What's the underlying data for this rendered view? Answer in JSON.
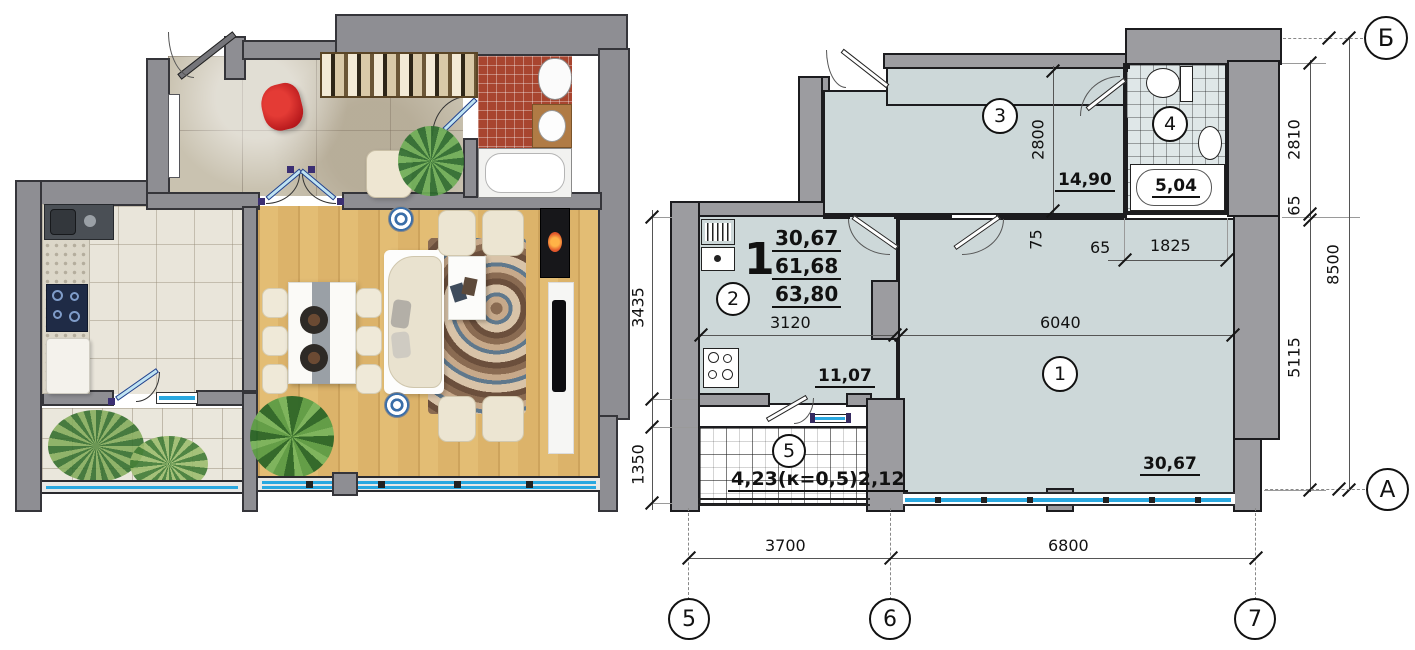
{
  "technical_plan": {
    "apartment": {
      "number": "1",
      "areas": [
        "30,67",
        "61,68",
        "63,80"
      ]
    },
    "rooms": [
      {
        "number": "1",
        "area": "30,67"
      },
      {
        "number": "2",
        "area": "11,07"
      },
      {
        "number": "3",
        "area": "14,90"
      },
      {
        "number": "4",
        "area": "5,04"
      },
      {
        "number": "5",
        "area": "4,23(к=0,5)2,12"
      }
    ],
    "dims": {
      "d2800": "2800",
      "d75": "75",
      "d65a": "65",
      "d1825": "1825",
      "d3120": "3120",
      "d6040": "6040",
      "d3435": "3435",
      "d1350": "1350",
      "d2810": "2810",
      "d65b": "65",
      "d5115": "5115",
      "d8500": "8500",
      "d3700": "3700",
      "d6800": "6800"
    },
    "axes": {
      "b": "Б",
      "a": "А",
      "n5": "5",
      "n6": "6",
      "n7": "7"
    }
  },
  "colors": {
    "tech_room_fill": "#cdd8d9",
    "wall_gray": "#9c9ca0",
    "window_blue": "#29a8e0",
    "bath_tile_red": "#a8452f",
    "wood_floor": "#dcb36a",
    "accent_red_chair": "#cf1f23"
  }
}
